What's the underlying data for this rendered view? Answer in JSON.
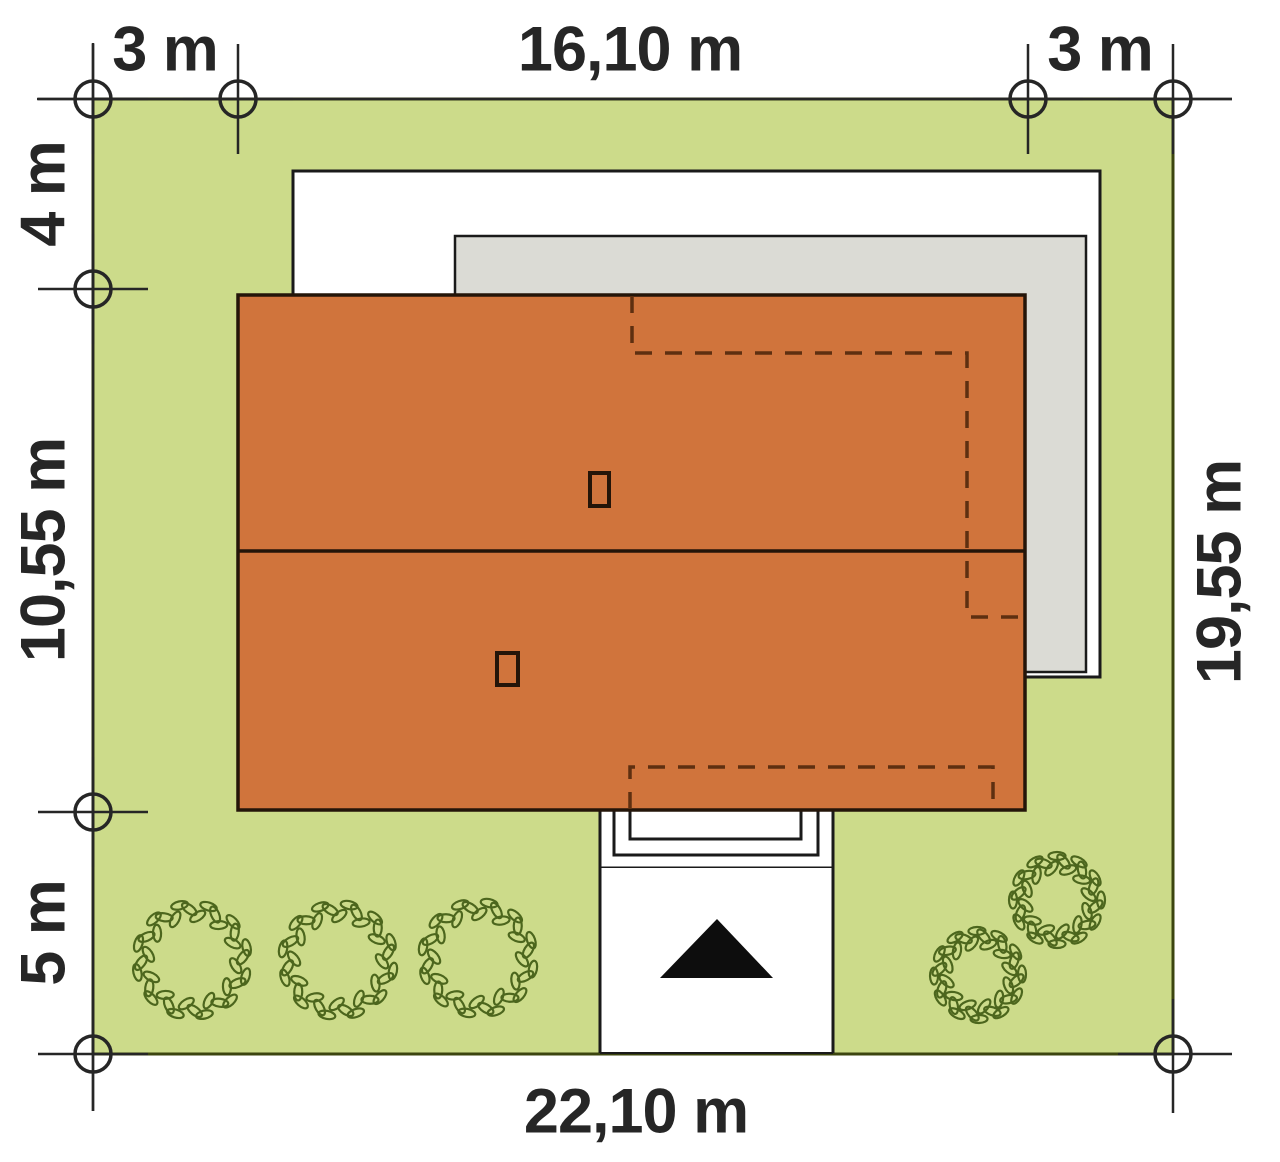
{
  "plan_title": "house plot site plan",
  "dims": {
    "top": [
      {
        "label": "3 m",
        "span_m": 3.0
      },
      {
        "label": "16,10 m",
        "span_m": 16.1
      },
      {
        "label": "3 m",
        "span_m": 3.0
      }
    ],
    "left": [
      {
        "label": "4 m",
        "span_m": 4.0
      },
      {
        "label": "10,55 m",
        "span_m": 10.55
      },
      {
        "label": "5 m",
        "span_m": 5.0
      }
    ],
    "right": [
      {
        "label": "19,55 m",
        "span_m": 19.55
      }
    ],
    "bottom": [
      {
        "label": "22,10 m",
        "span_m": 22.1
      }
    ]
  },
  "site": {
    "plot_width_m": 22.1,
    "plot_depth_m": 19.55,
    "house_width_m": 16.1,
    "house_depth_m": 10.55,
    "setback_left_m": 3.0,
    "setback_right_m": 3.0,
    "setback_back_m": 4.0,
    "setback_front_m": 5.0,
    "bushes": [
      {
        "cx": 192,
        "cy": 960,
        "r": 56
      },
      {
        "cx": 338,
        "cy": 960,
        "r": 56
      },
      {
        "cx": 478,
        "cy": 958,
        "r": 56
      },
      {
        "cx": 978,
        "cy": 975,
        "r": 44
      },
      {
        "cx": 1057,
        "cy": 900,
        "r": 44
      }
    ]
  },
  "colors": {
    "plot_green": "#ccdb8a",
    "plot_border": "#3c450f",
    "roof_orange": "#d0743c",
    "roof_border": "#241509",
    "shadow_gray": "#dbdbd5",
    "outline_black": "#1a1a1a",
    "dashed_brown": "#5e2f10",
    "leaf_green": "#4c661d",
    "dim_black": "#262626"
  }
}
